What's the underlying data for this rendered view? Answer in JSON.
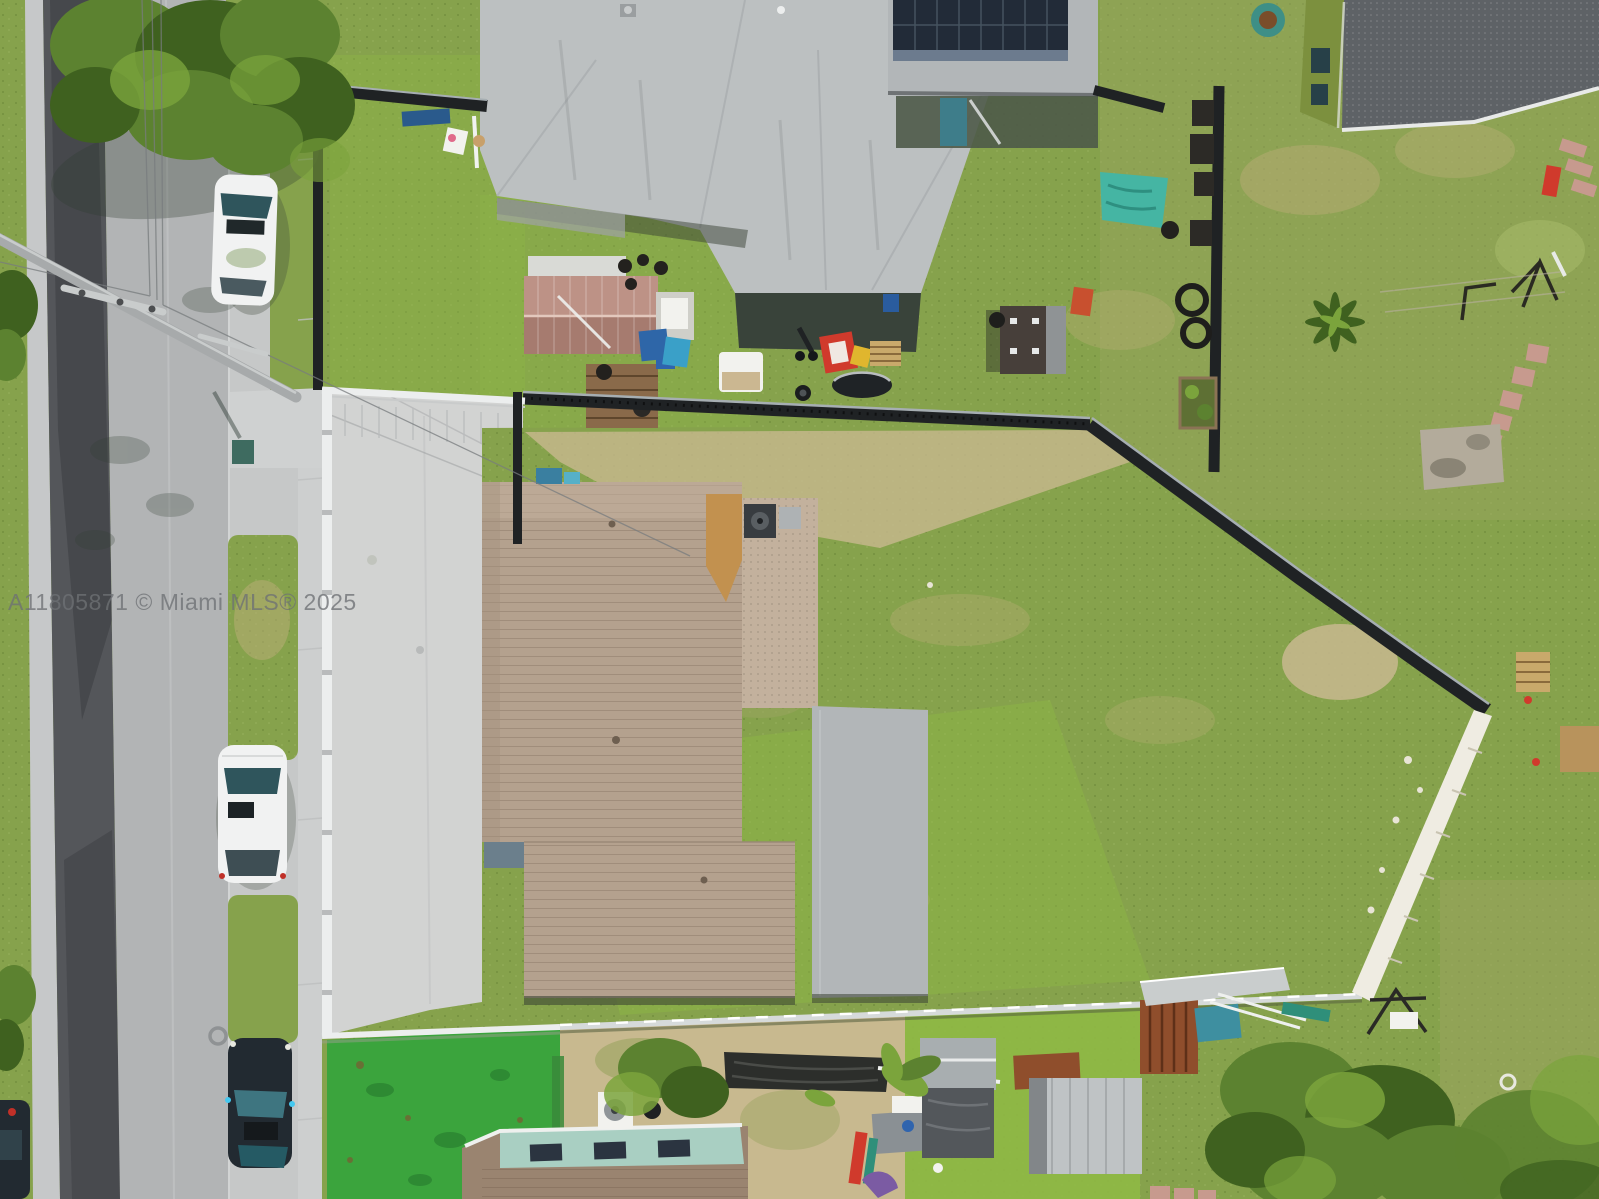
{
  "image": {
    "type": "aerial-drone-photo",
    "watermark": "A11805871 © Miami MLS® 2025",
    "scene": "Overhead aerial view of a residential lot: street with parked cars at left, white-fenced concrete driveway, tan shingle-roof house in the center, large fenced grass backyard with diagonal black fence and white rock wall, neighboring gray roofs and a solar-panel roof at top, green-walled house top right, cluttered neighbor yards, artificial turf and trees along the bottom"
  },
  "colors": {
    "grassBase": "#86a24c",
    "grassBright": "#8fb945",
    "grassLight": "#a9bd6b",
    "grassOlive": "#9aa45f",
    "grassDry": "#bcae78",
    "turfGreen": "#3ba43d",
    "turfDark": "#2e8a33",
    "treeDark": "#3f611f",
    "treeMid": "#5c8230",
    "treeLight": "#7ba43c",
    "roadAsphalt": "#54565a",
    "asphaltDark": "#46484c",
    "roadLight": "#b2b4b5",
    "gutterConcrete": "#c6c8c9",
    "sidewalk": "#cdcfcf",
    "driveway": "#d2d3d2",
    "drivewayShade": "#bfc1c2",
    "whiteFence": "#eceeee",
    "silverFence": "#d6dada",
    "blackFence": "#1f2224",
    "fenceHighlight": "#a6aeb2",
    "whiteWall": "#efece2",
    "roofGrayLight": "#bcc0c1",
    "roofGray": "#b2b6b8",
    "roofGrayDark": "#a6aaac",
    "eaveShadow": "#39433a",
    "solarPanel": "#222b38",
    "solarLine": "#45525f",
    "solarShadow": "#5f7186",
    "roofDarkGray": "#5e6266",
    "greenWall": "#7c903e",
    "roofTan": "#b4a18e",
    "roofTanLight": "#c3b19d",
    "roofTanDark": "#a5927f",
    "plywood": "#c2914f",
    "roofBrownBottom": "#9a8470",
    "tealRoof": "#a9cfc2",
    "shedMauve": "#bd9286",
    "shedMauveDark": "#a67b6f",
    "shedDark": "#473f3a",
    "shedGrayStripe": "#8f9395",
    "rust": "#8f4e2c",
    "tarpBlack": "#2c2e2b",
    "tealTarp": "#45b5a3",
    "sand": "#c8b98f",
    "woodBrown": "#8a6a4a",
    "carWhite": "#f1f2f2",
    "glassTeal": "#2f555c",
    "glassTealLight": "#3e7580",
    "carDark": "#222a31",
    "poleGray": "#a7aaab",
    "poleLight": "#c9cccc",
    "acTeal": "#3e7d8a",
    "redItem": "#d03a2c",
    "yellowItem": "#e0b62e",
    "blueItem": "#2f64ae",
    "tealItem": "#2f8f7a",
    "purpleItem": "#7b5ba3",
    "brickPink": "#c79a8e",
    "padGray": "#b3ab9b",
    "whiteItem": "#f2f2ee",
    "watermark": "#6e7175"
  }
}
